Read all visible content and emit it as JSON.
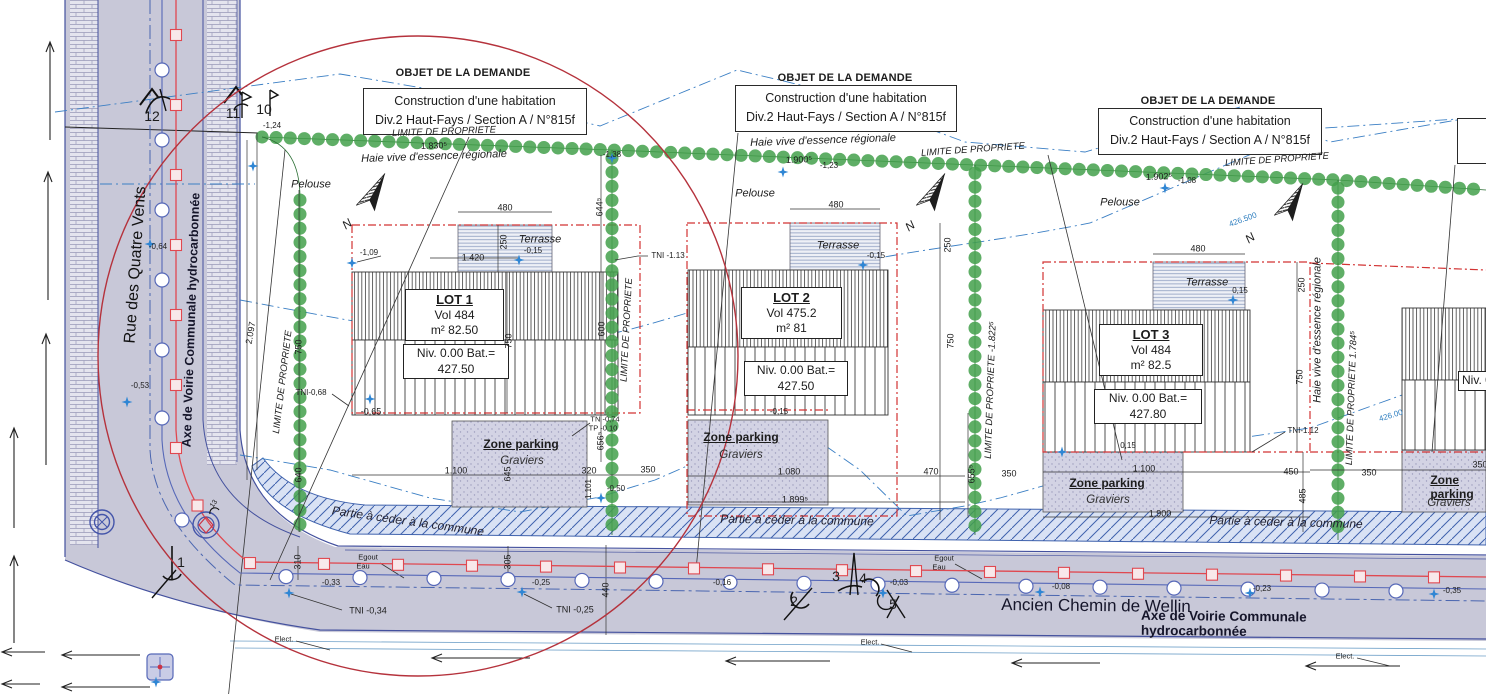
{
  "objet": {
    "title": "OBJET DE LA DEMANDE",
    "line1": "Construction d'une habitation",
    "line2": "Div.2 Haut-Fays / Section A  / N°815f"
  },
  "objet_partial": {
    "line1": "C",
    "line2": "Div."
  },
  "streets": {
    "rue": "Rue des Quatre Vents",
    "rue_axis": "Axe de Voirie Communale hydrocarbonnée",
    "chemin": "Ancien Chemin de Wellin",
    "chemin_axis": "Axe de Voirie Communale hydrocarbonnée"
  },
  "lots": [
    {
      "name": "LOT 1",
      "vol": "Vol 484",
      "area": "m² 82.50",
      "niv": "Niv. 0.00 Bat.=",
      "niv2": "427.50"
    },
    {
      "name": "LOT 2",
      "vol": "Vol 475.2",
      "area": "m² 81",
      "niv": "Niv. 0.00 Bat.=",
      "niv2": "427.50"
    },
    {
      "name": "LOT 3",
      "vol": "Vol 484",
      "area": "m² 82.5",
      "niv": "Niv. 0.00 Bat.=",
      "niv2": "427.80"
    },
    {
      "name": "",
      "vol": "",
      "area": "",
      "niv": "Niv. 0.00",
      "niv2": ""
    }
  ],
  "labels": {
    "zone_parking": "Zone parking",
    "graviers": "Graviers",
    "partie": "Partie à céder à la commune"
  },
  "colors": {
    "hedge_green": "#43a04b",
    "road_grey": "#c8c8d8",
    "red_dashed": "#d23333",
    "utility_red": "#e04850",
    "utility_blue": "#5668b8",
    "contour_blue": "#3b7fc4",
    "circle_red": "#b5323c"
  },
  "annotations": [
    {
      "t": "480",
      "x": 505,
      "y": 208
    },
    {
      "t": "480",
      "x": 836,
      "y": 205
    },
    {
      "t": "480",
      "x": 1198,
      "y": 249
    },
    {
      "t": "250",
      "x": 504,
      "y": 242,
      "r": -90
    },
    {
      "t": "250",
      "x": 948,
      "y": 245,
      "r": -90
    },
    {
      "t": "250",
      "x": 1302,
      "y": 285,
      "r": -90
    },
    {
      "t": "750",
      "x": 509,
      "y": 341,
      "r": -90
    },
    {
      "t": "750",
      "x": 951,
      "y": 341,
      "r": -90
    },
    {
      "t": "750",
      "x": 1300,
      "y": 377,
      "r": -90
    },
    {
      "t": "750",
      "x": 299,
      "y": 347,
      "r": -90
    },
    {
      "t": "600",
      "x": 602,
      "y": 329,
      "r": -90
    },
    {
      "t": "644⁵",
      "x": 600,
      "y": 207,
      "r": -90
    },
    {
      "t": "656⁵",
      "x": 601,
      "y": 441,
      "r": -90
    },
    {
      "t": "655⁵",
      "x": 972,
      "y": 474,
      "r": -90
    },
    {
      "t": "640",
      "x": 299,
      "y": 475,
      "r": -90
    },
    {
      "t": "645",
      "x": 508,
      "y": 474,
      "r": -90
    },
    {
      "t": "485",
      "x": 1303,
      "y": 496,
      "r": -90
    },
    {
      "t": "2.097",
      "x": 251,
      "y": 333,
      "r": -80
    },
    {
      "t": "310",
      "x": 298,
      "y": 562,
      "r": -90
    },
    {
      "t": "305",
      "x": 508,
      "y": 562,
      "r": -90
    },
    {
      "t": "440",
      "x": 606,
      "y": 590,
      "r": -90
    },
    {
      "t": "1.830⁵",
      "x": 434,
      "y": 146,
      "r": -2
    },
    {
      "t": "1.900⁵",
      "x": 799,
      "y": 160,
      "r": -2
    },
    {
      "t": "-1,23",
      "x": 829,
      "y": 166,
      "s": 8
    },
    {
      "t": "1.902⁵",
      "x": 1159,
      "y": 177,
      "r": -2
    },
    {
      "t": "-1,08",
      "x": 1187,
      "y": 181,
      "s": 8
    },
    {
      "t": "-1,24",
      "x": 272,
      "y": 126,
      "s": 8
    },
    {
      "t": "-1,38",
      "x": 612,
      "y": 155,
      "s": 8
    },
    {
      "t": "1.420",
      "x": 473,
      "y": 258
    },
    {
      "t": "-1,09",
      "x": 369,
      "y": 253,
      "s": 8
    },
    {
      "t": "-0,15",
      "x": 533,
      "y": 251,
      "s": 8
    },
    {
      "t": "-0,15",
      "x": 876,
      "y": 256,
      "s": 8
    },
    {
      "t": "0,15",
      "x": 1240,
      "y": 291,
      "s": 8
    },
    {
      "t": "-0,15",
      "x": 779,
      "y": 412,
      "s": 8
    },
    {
      "t": "0,15",
      "x": 1128,
      "y": 446,
      "s": 8
    },
    {
      "t": "TNI -1.13",
      "x": 668,
      "y": 256,
      "s": 8
    },
    {
      "t": "TNI-0,68",
      "x": 311,
      "y": 393,
      "s": 8
    },
    {
      "t": "-0,65",
      "x": 371,
      "y": 412,
      "s": 9
    },
    {
      "t": "TN -0,74",
      "x": 605,
      "y": 419,
      "s": 7.5
    },
    {
      "t": "TP -0,10",
      "x": 603,
      "y": 428,
      "s": 7.5
    },
    {
      "t": "-0.50",
      "x": 616,
      "y": 489,
      "s": 8
    },
    {
      "t": "TNI-1.12",
      "x": 1303,
      "y": 431,
      "s": 8
    },
    {
      "t": "TNI -0,34",
      "x": 368,
      "y": 611,
      "s": 9
    },
    {
      "t": "TNI -0,25",
      "x": 575,
      "y": 610,
      "s": 9
    },
    {
      "t": "-0,33",
      "x": 331,
      "y": 583,
      "s": 8
    },
    {
      "t": "-0,25",
      "x": 541,
      "y": 583,
      "s": 8
    },
    {
      "t": "-0,08",
      "x": 1061,
      "y": 587,
      "s": 8
    },
    {
      "t": "-0,23",
      "x": 1262,
      "y": 589,
      "s": 8
    },
    {
      "t": "-0,35",
      "x": 1452,
      "y": 591,
      "s": 8
    },
    {
      "t": "-0,03",
      "x": 899,
      "y": 583,
      "s": 8
    },
    {
      "t": "-0,16",
      "x": 722,
      "y": 583,
      "s": 8
    },
    {
      "t": "-0,64",
      "x": 158,
      "y": 247,
      "s": 8
    },
    {
      "t": "-0,53",
      "x": 140,
      "y": 386,
      "s": 8
    },
    {
      "t": "1.100",
      "x": 456,
      "y": 471
    },
    {
      "t": "320",
      "x": 589,
      "y": 471
    },
    {
      "t": "350",
      "x": 648,
      "y": 470
    },
    {
      "t": "1.101",
      "x": 589,
      "y": 489,
      "r": -90,
      "s": 8
    },
    {
      "t": "1.080",
      "x": 789,
      "y": 472
    },
    {
      "t": "1.899⁵",
      "x": 795,
      "y": 500
    },
    {
      "t": "470",
      "x": 931,
      "y": 472
    },
    {
      "t": "350",
      "x": 1009,
      "y": 474
    },
    {
      "t": "1.100",
      "x": 1144,
      "y": 469
    },
    {
      "t": "1.900",
      "x": 1160,
      "y": 514
    },
    {
      "t": "450",
      "x": 1291,
      "y": 472
    },
    {
      "t": "350",
      "x": 1369,
      "y": 473
    },
    {
      "t": "350",
      "x": 1480,
      "y": 465
    },
    {
      "t": "426.500",
      "x": 1243,
      "y": 220,
      "r": -20,
      "c": "blue",
      "s": 8
    },
    {
      "t": "426.00",
      "x": 1391,
      "y": 416,
      "r": -17,
      "c": "blue",
      "s": 8
    },
    {
      "t": "12",
      "x": 152,
      "y": 116,
      "s": 14
    },
    {
      "t": "11",
      "x": 233,
      "y": 113,
      "s": 14
    },
    {
      "t": "10",
      "x": 264,
      "y": 109,
      "s": 14
    },
    {
      "t": "1",
      "x": 181,
      "y": 562,
      "s": 14
    },
    {
      "t": "2",
      "x": 794,
      "y": 601,
      "s": 14
    },
    {
      "t": "3",
      "x": 836,
      "y": 576,
      "s": 14
    },
    {
      "t": "4",
      "x": 863,
      "y": 578,
      "s": 14
    },
    {
      "t": "5",
      "x": 893,
      "y": 604,
      "s": 14
    },
    {
      "t": "13",
      "x": 214,
      "y": 504,
      "r": -55,
      "s": 7
    },
    {
      "t": "LIMITE DE PROPRIETE",
      "x": 283,
      "y": 382,
      "r": -83,
      "i": 1,
      "s": 9.5
    },
    {
      "t": "LIMITE DE PROPRIETE",
      "x": 627,
      "y": 330,
      "r": -87,
      "i": 1,
      "s": 9.5
    },
    {
      "t": "LIMITE DE PROPRIETE -1.822⁵",
      "x": 991,
      "y": 390,
      "r": -88,
      "i": 1,
      "s": 9.5
    },
    {
      "t": "LIMITE DE PROPRIETE 1.784⁵",
      "x": 1352,
      "y": 398,
      "r": -88,
      "i": 1,
      "s": 9.5
    },
    {
      "t": "LIMITE DE PROPRIETE",
      "x": 444,
      "y": 132,
      "r": -2,
      "i": 1,
      "s": 9.5
    },
    {
      "t": "LIMITE DE PROPRIETE",
      "x": 973,
      "y": 150,
      "r": -4,
      "i": 1,
      "s": 9.5
    },
    {
      "t": "LIMITE DE PROPRIETE",
      "x": 1277,
      "y": 160,
      "r": -4,
      "i": 1,
      "s": 9.5
    },
    {
      "t": "Haie vive d'essence régionale",
      "x": 434,
      "y": 157,
      "r": -2,
      "i": 1,
      "s": 11
    },
    {
      "t": "Haie vive d'essence régionale",
      "x": 823,
      "y": 141,
      "r": -2,
      "i": 1,
      "s": 11
    },
    {
      "t": "Haie vive d'essence régionale",
      "x": 1318,
      "y": 330,
      "r": -90,
      "i": 1,
      "s": 11
    },
    {
      "t": "Pelouse",
      "x": 311,
      "y": 185,
      "i": 1,
      "s": 11
    },
    {
      "t": "Pelouse",
      "x": 755,
      "y": 194,
      "i": 1,
      "s": 11
    },
    {
      "t": "Pelouse",
      "x": 1120,
      "y": 203,
      "i": 1,
      "s": 11
    },
    {
      "t": "Terrasse",
      "x": 540,
      "y": 240,
      "i": 1,
      "s": 11
    },
    {
      "t": "Terrasse",
      "x": 838,
      "y": 246,
      "i": 1,
      "s": 11
    },
    {
      "t": "Terrasse",
      "x": 1207,
      "y": 283,
      "i": 1,
      "s": 11
    },
    {
      "t": "Egout",
      "x": 368,
      "y": 557,
      "s": 7.5
    },
    {
      "t": "Eau",
      "x": 363,
      "y": 566,
      "s": 7.5
    },
    {
      "t": "Egout",
      "x": 944,
      "y": 558,
      "s": 7.5
    },
    {
      "t": "Eau",
      "x": 939,
      "y": 567,
      "s": 7.5
    },
    {
      "t": "Elect.",
      "x": 284,
      "y": 639,
      "s": 7.5
    },
    {
      "t": "Elect.",
      "x": 870,
      "y": 642,
      "s": 7.5
    },
    {
      "t": "Elect.",
      "x": 1345,
      "y": 656,
      "s": 7.5
    },
    {
      "t": "N",
      "x": 347,
      "y": 224,
      "r": -35,
      "i": 1,
      "s": 12
    },
    {
      "t": "N",
      "x": 910,
      "y": 226,
      "r": -35,
      "i": 1,
      "s": 12
    },
    {
      "t": "N",
      "x": 1250,
      "y": 238,
      "r": -35,
      "i": 1,
      "s": 12
    }
  ]
}
